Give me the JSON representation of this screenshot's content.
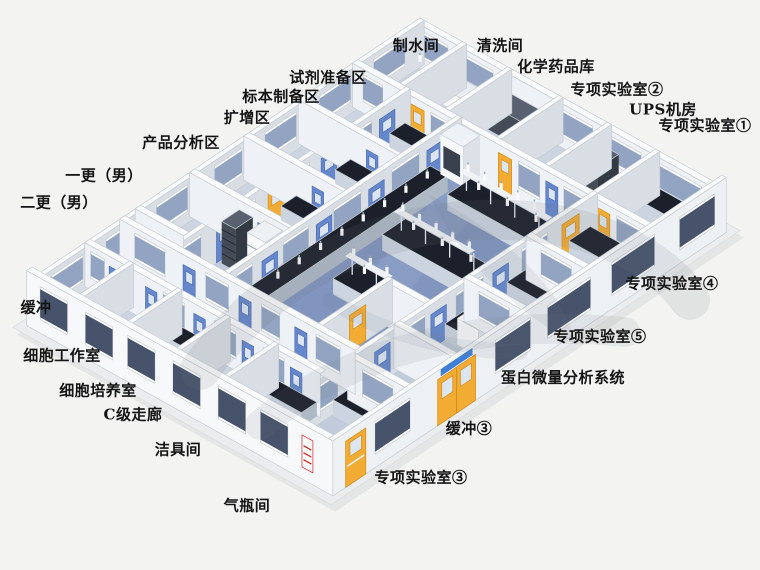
{
  "scene": {
    "background": "#f3f4f2",
    "description_labels_count": 23
  },
  "colors": {
    "background": "#f3f4f2",
    "slab": "#ebeced",
    "slab_shadow": "#dddfdf",
    "floor_base": "#9fadca",
    "floor_lab": "#8195bf",
    "floor_room_light": "#ccd4e1",
    "floor_room_mid": "#c2cbdb",
    "floor_corridor": "#9eb0d1",
    "wall_face_light": "#eef1f5",
    "wall_face_dark": "#d9dee5",
    "wall_top": "#fafbfc",
    "wall_edge": "#c6ccd3",
    "ext_face_left": "#f7f8fa",
    "ext_face_right": "#eef1f4",
    "door_yellow": "#f2ab33",
    "door_yellow_dark": "#d28d1e",
    "door_blue": "#6687cc",
    "door_blue_dark": "#4f6fb4",
    "door_glass": "#dce6f2",
    "window_glass_dark": "#46536a",
    "window_glass_light": "#92a4c2",
    "window_frame": "#ffffff",
    "bench_top": "#1b202b",
    "bench_front": "#ccd5df",
    "bench_side": "#aeb9c6",
    "equip_white": "#f6f8fa",
    "rack_dark": "#454c57",
    "rack_dark_side": "#343a43",
    "rack_top": "#596170",
    "sign_red": "#cc2222",
    "sign_blue": "#3f7fd6",
    "watermark": "#6e747c",
    "label_color": "#141414"
  },
  "labels": [
    {
      "id": "water-production-room",
      "text": "制水间"
    },
    {
      "id": "washing-room",
      "text": "清洗间"
    },
    {
      "id": "chemical-storage",
      "text": "化学药品库"
    },
    {
      "id": "special-lab-2",
      "text": "专项实验室②"
    },
    {
      "id": "ups-room",
      "text": "UPS机房"
    },
    {
      "id": "special-lab-1",
      "text": "专项实验室①"
    },
    {
      "id": "reagent-prep-area",
      "text": "试剂准备区"
    },
    {
      "id": "specimen-prep-area",
      "text": "标本制备区"
    },
    {
      "id": "amplification-area",
      "text": "扩增区"
    },
    {
      "id": "product-analysis-area",
      "text": "产品分析区"
    },
    {
      "id": "first-change-male",
      "text": "一更（男）"
    },
    {
      "id": "second-change-male",
      "text": "二更（男）"
    },
    {
      "id": "buffer-left",
      "text": "缓冲"
    },
    {
      "id": "cell-workroom",
      "text": "细胞工作室"
    },
    {
      "id": "cell-culture-room",
      "text": "细胞培养室"
    },
    {
      "id": "c-grade-corridor",
      "text": "C级走廊"
    },
    {
      "id": "cleaning-tools-room",
      "text": "洁具间"
    },
    {
      "id": "gas-cylinder-room",
      "text": "气瓶间"
    },
    {
      "id": "special-lab-3",
      "text": "专项实验室③"
    },
    {
      "id": "buffer-3",
      "text": "缓冲③"
    },
    {
      "id": "protein-microanalysis-system",
      "text": "蛋白微量分析系统"
    },
    {
      "id": "special-lab-5",
      "text": "专项实验室⑤"
    },
    {
      "id": "special-lab-4",
      "text": "专项实验室④"
    }
  ]
}
